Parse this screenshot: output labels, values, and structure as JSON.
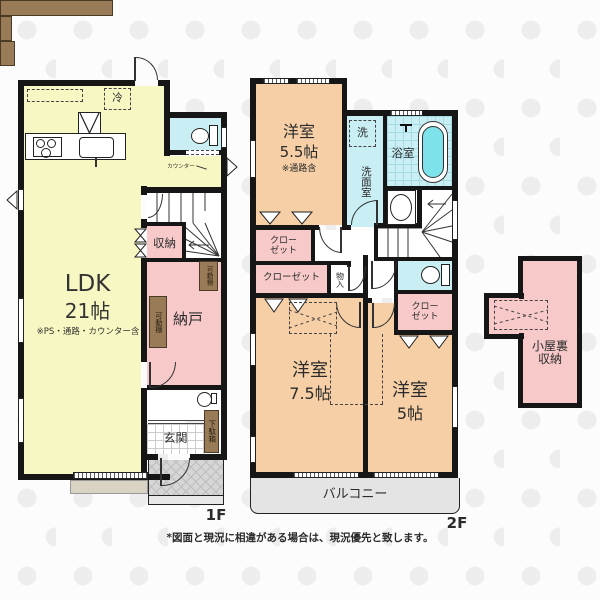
{
  "floor1": {
    "label": "1F",
    "ldk": {
      "line1": "LDK",
      "line2": "21帖",
      "note": "※PS・通路・カウンター含"
    },
    "rooms": {
      "shuno": "収納",
      "nando": "納戸",
      "genkan": "玄関",
      "getabako": "下駄箱",
      "kadodana": "可動棚",
      "refrigerator": "冷",
      "counter": "カウンター"
    }
  },
  "floor2": {
    "label": "2F",
    "yoshitsu55": {
      "line1": "洋室",
      "line2": "5.5帖",
      "note": "※通路含"
    },
    "yoshitsu75": {
      "line1": "洋室",
      "line2": "7.5帖"
    },
    "yoshitsu5": {
      "line1": "洋室",
      "line2": "5帖"
    },
    "rooms": {
      "washer": "洗",
      "senmenshitsu": "洗面室",
      "yokushitsu": "浴室",
      "closet1a": "クロー",
      "closet1b": "ゼット",
      "closet2": "クローゼット",
      "monoire": "物入",
      "closet3a": "クロー",
      "closet3b": "ゼット",
      "balcony": "バルコニー"
    }
  },
  "attic": {
    "line1": "小屋裏",
    "line2": "収納"
  },
  "footer": {
    "disclaimer": "*図面と現況に相違がある場合は、現況優先と致します。"
  },
  "colors": {
    "ldk_yellow": "#f7f7c3",
    "room_pink": "#f7c9c9",
    "room_peach": "#f6cfa6",
    "wet_cyan": "#c9eef3",
    "bathtub": "#7de2ea",
    "wood_brown": "#9a7b57",
    "balcony_gray": "#e4e4e4",
    "wall_black": "#161616"
  }
}
